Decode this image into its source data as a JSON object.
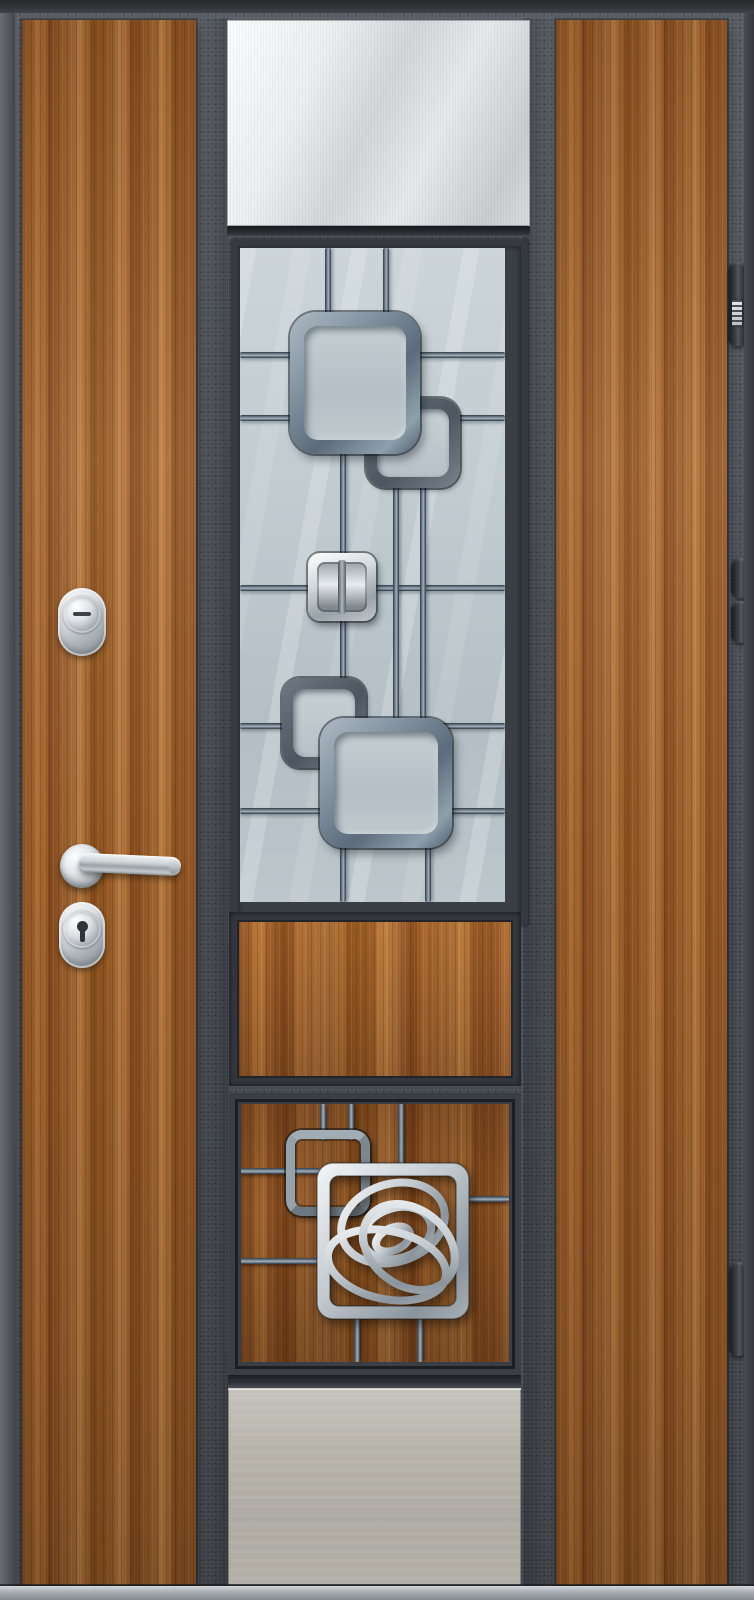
{
  "scene": {
    "type": "photograph",
    "subject": "Steel entrance door with golden-oak vertical panels, stainless-steel inserts, decorative glazed grille with rounded squares, rose-motif plate, chrome lever handle, two cylinder locks and three edge hinges",
    "palette": {
      "frame": "#4e545b",
      "frame-dark": "#33373c",
      "frame-edge": "#5d6268",
      "wood-hi": "#c07a3e",
      "wood-mid": "#a4622c",
      "wood-low": "#7e4218",
      "glass-hi": "#ccd5d9",
      "glass-lo": "#b3bfc5",
      "grille-steel": "#6b7886",
      "grille-dark": "#39414b",
      "steel-hi": "#f7f8f9",
      "steel-lo": "#c6cacd",
      "kick-hi": "#bdbab2",
      "kick-lo": "#a39f97",
      "chrome-hi": "#f4f6f7",
      "chrome-lo": "#8f979d",
      "shadow": "#202327"
    },
    "parts": [
      "door-face",
      "left-wood-panel",
      "right-wood-panel",
      "top-steel-panel",
      "glass-window",
      "window-grille",
      "chrome-square-accent",
      "wood-insert-panel",
      "lower-grille-panel",
      "rose-plate",
      "bottom-steel-panel",
      "upper-cylinder-lock",
      "lower-cylinder-lock",
      "door-handle",
      "hinge-top",
      "hinge-middle",
      "hinge-bottom",
      "threshold"
    ]
  }
}
